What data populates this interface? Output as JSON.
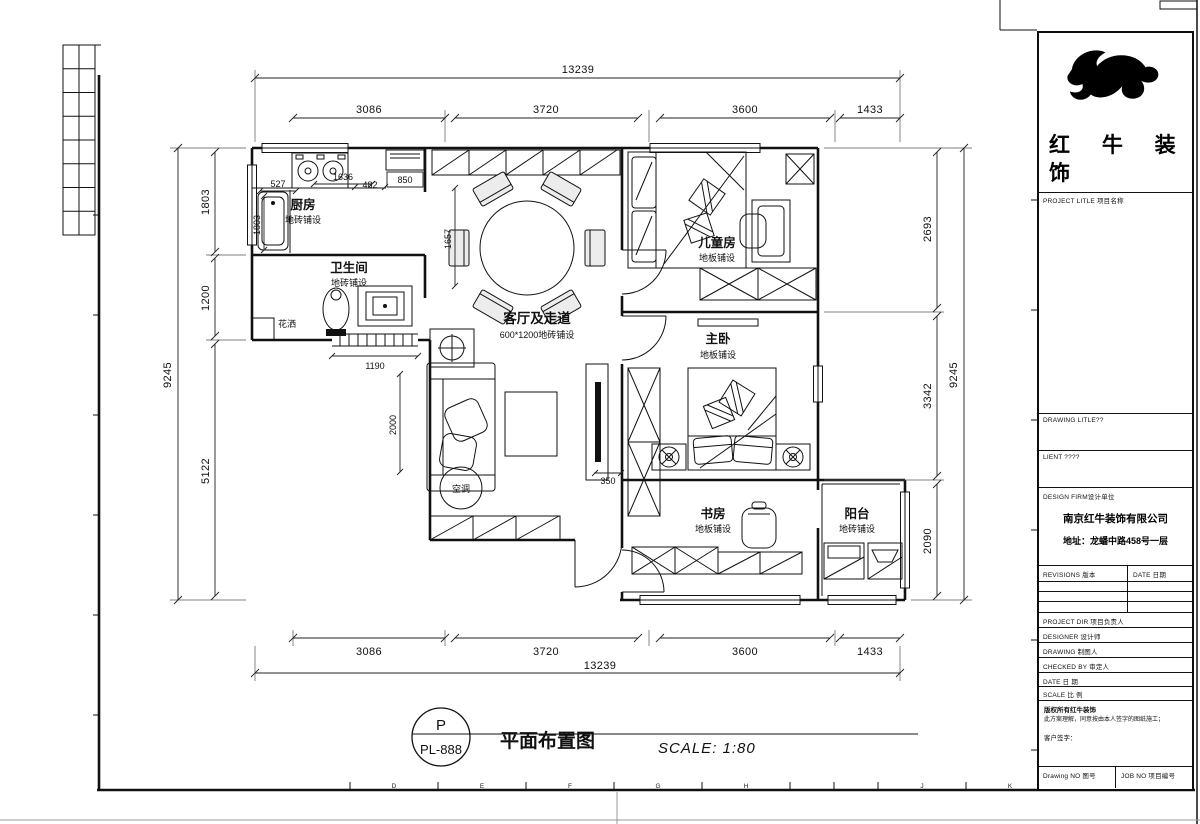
{
  "plan": {
    "rooms": [
      {
        "name": "厨房",
        "finish": "地砖铺设"
      },
      {
        "name": "卫生间",
        "finish": "地砖铺设"
      },
      {
        "name": "客厅及走道",
        "finish": "600*1200地砖铺设"
      },
      {
        "name": "儿童房",
        "finish": "地板铺设"
      },
      {
        "name": "主卧",
        "finish": "地板铺设"
      },
      {
        "name": "书房",
        "finish": "地板铺设"
      },
      {
        "name": "阳台",
        "finish": "地砖铺设"
      }
    ],
    "fixtures": {
      "shower": "花洒",
      "ac": "空调"
    },
    "dims": {
      "top_total": "13239",
      "bottom_total": "13239",
      "top": [
        "3086",
        "3720",
        "3600",
        "1433"
      ],
      "bottom": [
        "3086",
        "3720",
        "3600",
        "1433"
      ],
      "left": [
        "1803",
        "1200",
        "5122"
      ],
      "left_total": "9245",
      "right": [
        "2693",
        "3342",
        "2090"
      ],
      "right_total": "9245",
      "interior": {
        "a": "527",
        "b": "1803",
        "c": "1636",
        "d": "482",
        "e": "850",
        "f": "1657",
        "g": "1190",
        "h": "2000",
        "i": "350"
      }
    }
  },
  "sheet": {
    "stamp_letter": "P",
    "stamp_code": "PL-888",
    "drawing_title": "平面布置图",
    "scale_note": "SCALE: 1:80",
    "grid_letters": [
      "D",
      "E",
      "F",
      "G",
      "H",
      "J",
      "K"
    ]
  },
  "title_block": {
    "brand_line1": "红 牛 装",
    "brand_line2": "饰",
    "project_title_label": "PROJECT LITLE 项目名称",
    "drawing_title_label": "DRAWING LITLE??",
    "client_label": "LIENT ????",
    "design_firm_label": "DESIGN FIRM设计单位",
    "company_name": "南京红牛装饰有限公司",
    "company_address": "地址：龙蟠中路458号一层",
    "revisions_label": "REVISIONS 版本",
    "revisions_date_label": "DATE 日期",
    "project_dir_label": "PROJECT DIR  项目负责人",
    "designer_label": "DESIGNER  设计师",
    "drawing_label": "DRAWING  制图人",
    "checked_by_label": "CHECKED BY  审定人",
    "date_label": "DATE  日 期",
    "scale_label": "SCALE  比 例",
    "copyright_line1": "版权所有红牛装饰",
    "copyright_line2": "此方案理解，同意按由本人签字的图纸施工；",
    "customer_sign_label": "客户签字：",
    "drawing_no_label": "Drawing NO 图号",
    "job_no_label": "JOB NO 项目编号"
  }
}
